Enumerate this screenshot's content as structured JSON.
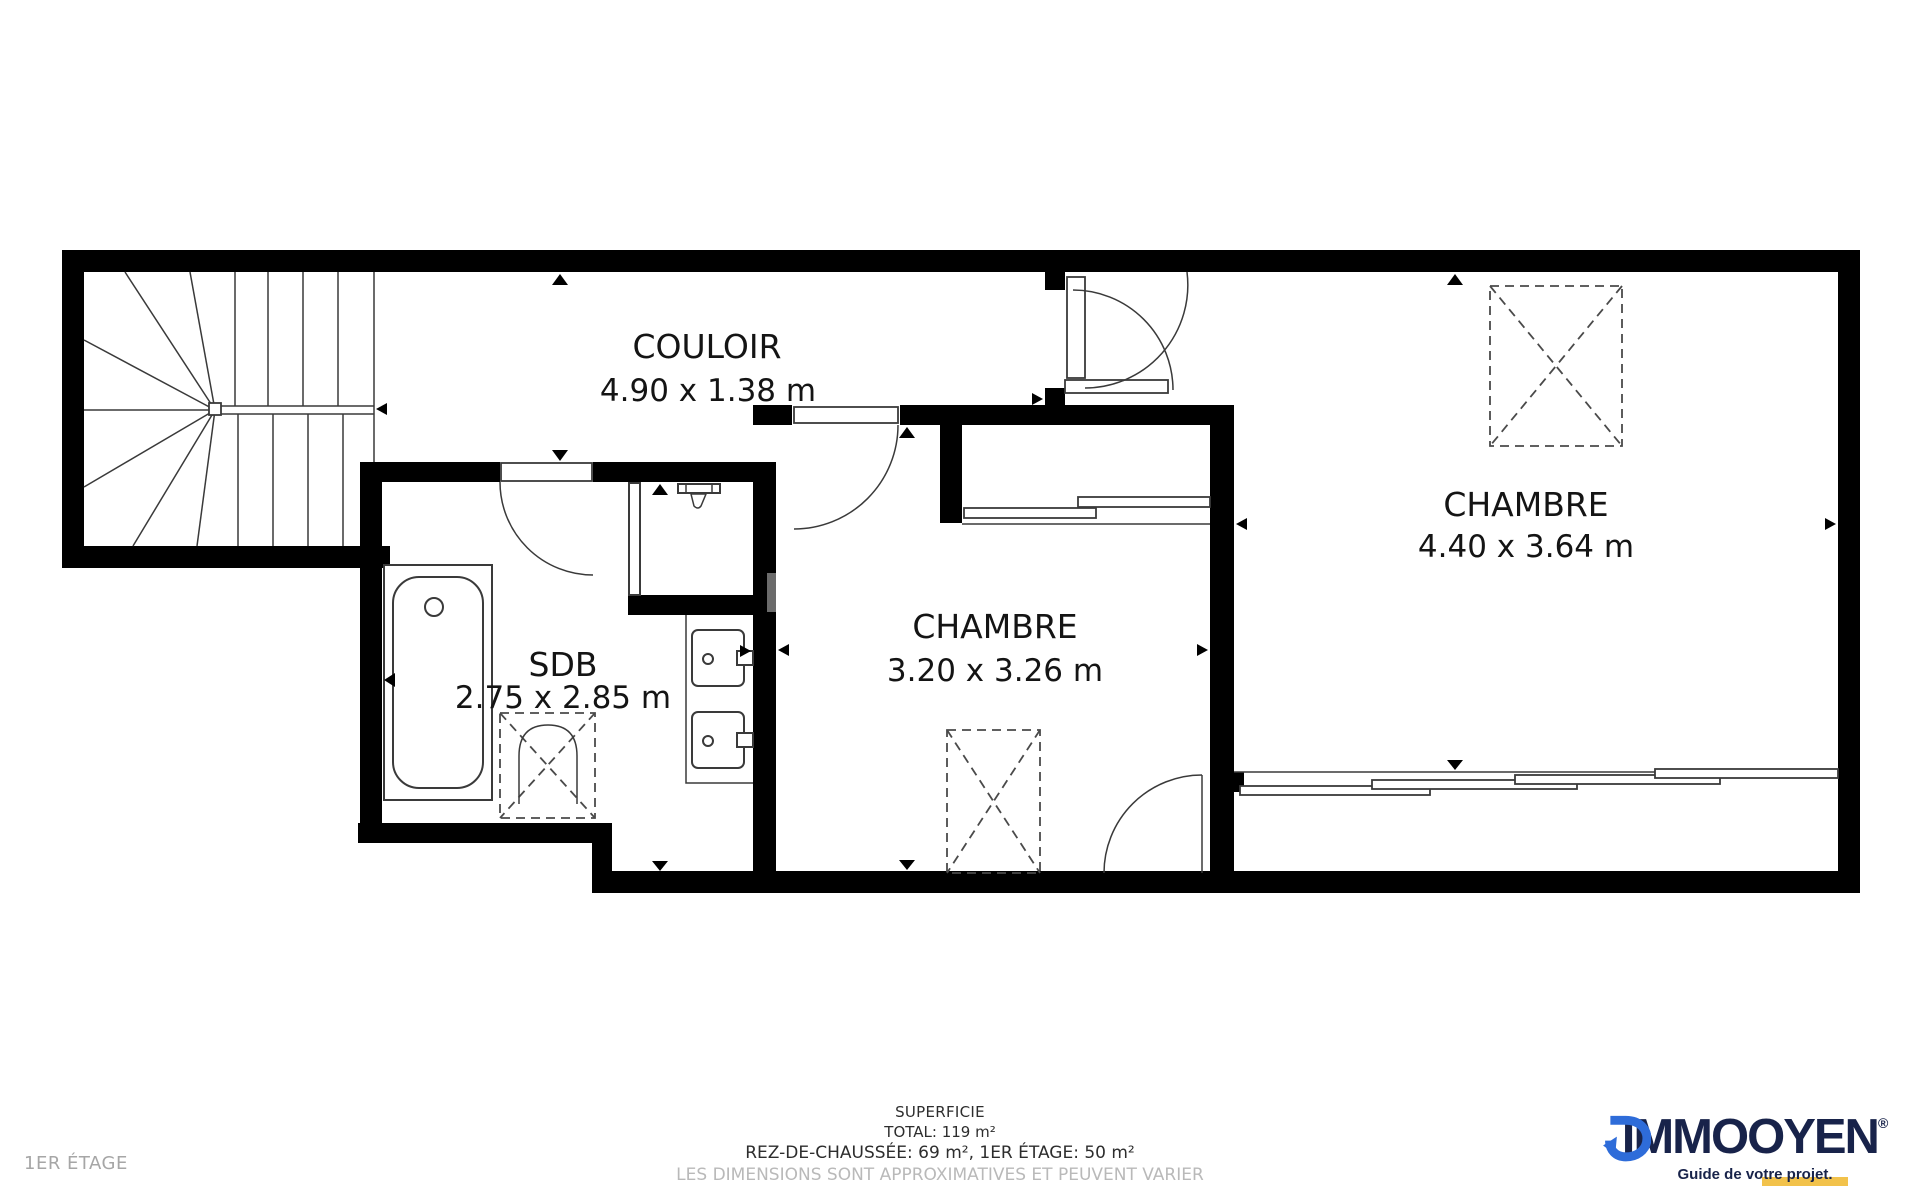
{
  "floor_label": "1ER ÉTAGE",
  "rooms": {
    "couloir": {
      "name": "COULOIR",
      "dims": "4.90 x 1.38 m"
    },
    "chambre_small": {
      "name": "CHAMBRE",
      "dims": "3.20 x 3.26 m"
    },
    "chambre_large": {
      "name": "CHAMBRE",
      "dims": "4.40 x 3.64 m"
    },
    "sdb": {
      "name": "SDB",
      "dims": "2.75 x 2.85 m"
    }
  },
  "footer": {
    "superficie_label": "SUPERFICIE",
    "total": "TOTAL: 119 m²",
    "breakdown": "REZ-DE-CHAUSSÉE: 69 m², 1ER ÉTAGE: 50 m²",
    "disclaimer": "LES DIMENSIONS SONT APPROXIMATIVES ET PEUVENT VARIER"
  },
  "logo": {
    "brand_left": "IMMO",
    "brand_right": "OYEN",
    "registered": "®",
    "tagline": "Guide de votre projet.",
    "mark": "d-circular-arrow-logo"
  },
  "colors": {
    "wall": "#000000",
    "line": "#3a3a3a",
    "navy": "#18234a",
    "blue": "#2e6cd9",
    "yellow": "#f2c24b",
    "muted": "#b9b9b9",
    "ink": "#2d2d2d"
  }
}
